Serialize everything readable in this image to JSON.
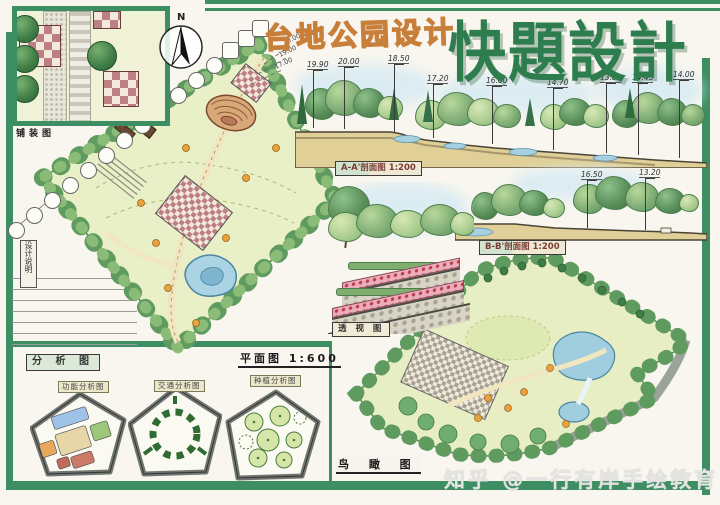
{
  "titles": {
    "project": "台地公园设计",
    "big": "快題設計"
  },
  "compass": {
    "label": "N"
  },
  "panels": {
    "paving_detail_label": "铺装图",
    "design_notes_label": "设计说明",
    "analysis_title": "分 析 图",
    "function_analysis_label": "功能分析图",
    "traffic_analysis_label": "交通分析图",
    "planting_analysis_label": "种植分析图",
    "plan_label": "平面图 1:600",
    "perspective_label": "透 视 图",
    "birdseye_label": "鸟 瞰 图",
    "section_a_label": "A-A'剖面图 1:200",
    "section_b_label": "B-B'剖面图 1:200"
  },
  "sections": {
    "a_elevations": [
      "19.90",
      "20.00",
      "18.50",
      "17.20",
      "16.00",
      "14.70",
      "13.85",
      "14.45",
      "14.00"
    ],
    "b_elevations": [
      "16.50",
      "13.20"
    ],
    "plan_leaders": [
      "20.00",
      "19.00",
      "17.00"
    ]
  },
  "watermark": "知乎 @一行有岸手绘教育",
  "colors": {
    "frame_green": "#3e8e63",
    "title_green": "#2e7d4f",
    "title_orange": "#c87f3a",
    "sky_blue": "#d5eaf3",
    "lawn": "#e9efc6",
    "pond": "#a0cede",
    "paving_red": "#bc7f82",
    "ground_tan": "#e0cf96"
  }
}
